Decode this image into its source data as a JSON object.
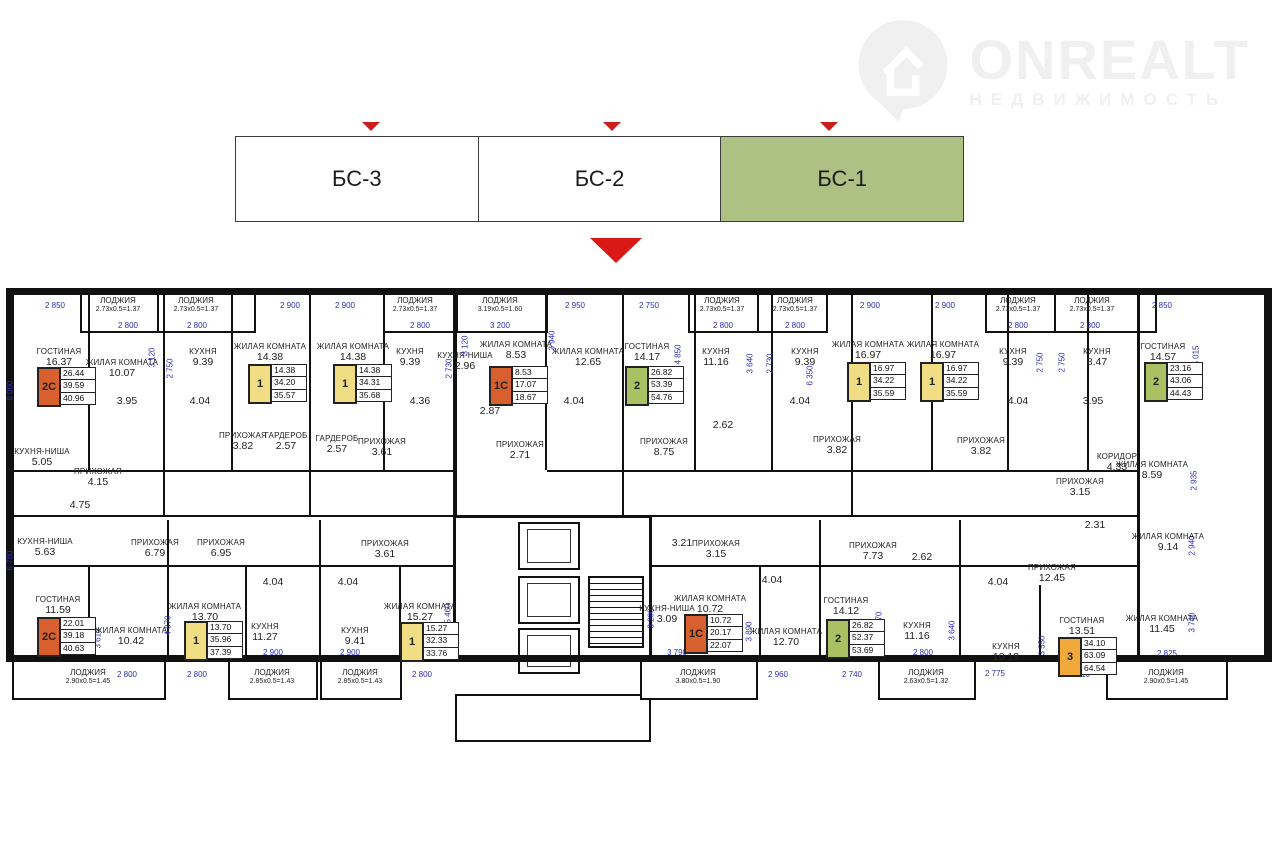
{
  "logo": {
    "name": "ONREALT",
    "subtitle": "НЕДВИЖИМОСТЬ"
  },
  "tabs": {
    "items": [
      {
        "label": "БС-3",
        "active": false
      },
      {
        "label": "БС-2",
        "active": false
      },
      {
        "label": "БС-1",
        "active": true
      }
    ],
    "active_color": "#aec185",
    "marker_color": "#c8201c"
  },
  "plan": {
    "rooms": [
      {
        "n": "ГОСТИНАЯ",
        "a": "16.37",
        "x": 59,
        "y": 352
      },
      {
        "n": "ЖИЛАЯ КОМНАТА",
        "a": "10.07",
        "x": 122,
        "y": 363
      },
      {
        "n": "КУХНЯ",
        "a": "9.39",
        "x": 203,
        "y": 352
      },
      {
        "n": "ЖИЛАЯ КОМНАТА",
        "a": "14.38",
        "x": 270,
        "y": 347
      },
      {
        "n": "ЖИЛАЯ КОМНАТА",
        "a": "14.38",
        "x": 353,
        "y": 347
      },
      {
        "n": "КУХНЯ",
        "a": "9.39",
        "x": 410,
        "y": 352
      },
      {
        "n": "КУХНЯ-НИША",
        "a": "2.96",
        "x": 465,
        "y": 356
      },
      {
        "n": "ЖИЛАЯ КОМНАТА",
        "a": "8.53",
        "x": 516,
        "y": 345
      },
      {
        "n": "ЖИЛАЯ КОМНАТА",
        "a": "12.65",
        "x": 588,
        "y": 352
      },
      {
        "n": "ГОСТИНАЯ",
        "a": "14.17",
        "x": 647,
        "y": 347
      },
      {
        "n": "КУХНЯ",
        "a": "11.16",
        "x": 716,
        "y": 352
      },
      {
        "n": "КУХНЯ",
        "a": "9.39",
        "x": 805,
        "y": 352
      },
      {
        "n": "ЖИЛАЯ КОМНАТА",
        "a": "16.97",
        "x": 868,
        "y": 345
      },
      {
        "n": "ЖИЛАЯ КОМНАТА",
        "a": "16.97",
        "x": 943,
        "y": 345
      },
      {
        "n": "КУХНЯ",
        "a": "9.39",
        "x": 1013,
        "y": 352
      },
      {
        "n": "КУХНЯ",
        "a": "8.47",
        "x": 1097,
        "y": 352
      },
      {
        "n": "ГОСТИНАЯ",
        "a": "14.57",
        "x": 1163,
        "y": 347
      },
      {
        "n": "КУХНЯ-НИША",
        "a": "5.05",
        "x": 42,
        "y": 452
      },
      {
        "n": "ПРИХОЖАЯ",
        "a": "4.15",
        "x": 98,
        "y": 472
      },
      {
        "n": "ПРИХОЖАЯ",
        "a": "3.82",
        "x": 243,
        "y": 436
      },
      {
        "n": "ГАРДЕРОБ",
        "a": "2.57",
        "x": 286,
        "y": 436
      },
      {
        "n": "ГАРДЕРОБ",
        "a": "2.57",
        "x": 337,
        "y": 439
      },
      {
        "n": "ПРИХОЖАЯ",
        "a": "3.61",
        "x": 382,
        "y": 442
      },
      {
        "n": "ПРИХОЖАЯ",
        "a": "2.71",
        "x": 520,
        "y": 445
      },
      {
        "n": "ПРИХОЖАЯ",
        "a": "8.75",
        "x": 664,
        "y": 442
      },
      {
        "n": "ПРИХОЖАЯ",
        "a": "3.82",
        "x": 837,
        "y": 440
      },
      {
        "n": "ПРИХОЖАЯ",
        "a": "3.82",
        "x": 981,
        "y": 441
      },
      {
        "n": "КОРИДОР",
        "a": "4.33",
        "x": 1117,
        "y": 457
      },
      {
        "n": "ПРИХОЖАЯ",
        "a": "3.15",
        "x": 1080,
        "y": 482
      },
      {
        "n": "ЖИЛАЯ КОМНАТА",
        "a": "8.59",
        "x": 1152,
        "y": 465
      },
      {
        "n": "",
        "a": "3.95",
        "x": 127,
        "y": 400
      },
      {
        "n": "",
        "a": "4.04",
        "x": 200,
        "y": 400
      },
      {
        "n": "",
        "a": "4.36",
        "x": 420,
        "y": 400
      },
      {
        "n": "",
        "a": "2.87",
        "x": 490,
        "y": 410
      },
      {
        "n": "",
        "a": "4.04",
        "x": 574,
        "y": 400
      },
      {
        "n": "",
        "a": "2.62",
        "x": 723,
        "y": 424
      },
      {
        "n": "",
        "a": "4.04",
        "x": 800,
        "y": 400
      },
      {
        "n": "",
        "a": "4.04",
        "x": 1018,
        "y": 400
      },
      {
        "n": "",
        "a": "3.95",
        "x": 1093,
        "y": 400
      },
      {
        "n": "",
        "a": "4.75",
        "x": 80,
        "y": 504
      },
      {
        "n": "КУХНЯ-НИША",
        "a": "5.63",
        "x": 45,
        "y": 542
      },
      {
        "n": "ПРИХОЖАЯ",
        "a": "6.79",
        "x": 155,
        "y": 543
      },
      {
        "n": "ПРИХОЖАЯ",
        "a": "6.95",
        "x": 221,
        "y": 543
      },
      {
        "n": "ГОСТИНАЯ",
        "a": "11.59",
        "x": 58,
        "y": 600
      },
      {
        "n": "ЖИЛАЯ КОМНАТА",
        "a": "10.42",
        "x": 131,
        "y": 631
      },
      {
        "n": "ЖИЛАЯ КОМНАТА",
        "a": "13.70",
        "x": 205,
        "y": 607
      },
      {
        "n": "КУХНЯ",
        "a": "11.27",
        "x": 265,
        "y": 627
      },
      {
        "n": "ПРИХОЖАЯ",
        "a": "3.61",
        "x": 385,
        "y": 544
      },
      {
        "n": "КУХНЯ",
        "a": "9.41",
        "x": 355,
        "y": 631
      },
      {
        "n": "ЖИЛАЯ КОМНАТА",
        "a": "15.27",
        "x": 420,
        "y": 607
      },
      {
        "n": "",
        "a": "4.04",
        "x": 273,
        "y": 581
      },
      {
        "n": "",
        "a": "4.04",
        "x": 348,
        "y": 581
      },
      {
        "n": "",
        "a": "3.21",
        "x": 682,
        "y": 542
      },
      {
        "n": "ПРИХОЖАЯ",
        "a": "3.15",
        "x": 716,
        "y": 544
      },
      {
        "n": "КУХНЯ-НИША",
        "a": "3.09",
        "x": 667,
        "y": 609
      },
      {
        "n": "ЖИЛАЯ КОМНАТА",
        "a": "10.72",
        "x": 710,
        "y": 599
      },
      {
        "n": "",
        "a": "4.04",
        "x": 772,
        "y": 579
      },
      {
        "n": "ЖИЛАЯ КОМНАТА",
        "a": "12.70",
        "x": 786,
        "y": 632
      },
      {
        "n": "ГОСТИНАЯ",
        "a": "14.12",
        "x": 846,
        "y": 601
      },
      {
        "n": "ПРИХОЖАЯ",
        "a": "7.73",
        "x": 873,
        "y": 546
      },
      {
        "n": "",
        "a": "2.62",
        "x": 922,
        "y": 556
      },
      {
        "n": "КУХНЯ",
        "a": "11.16",
        "x": 917,
        "y": 626
      },
      {
        "n": "",
        "a": "4.04",
        "x": 998,
        "y": 581
      },
      {
        "n": "",
        "a": "2.31",
        "x": 1095,
        "y": 524
      },
      {
        "n": "ПРИХОЖАЯ",
        "a": "12.45",
        "x": 1052,
        "y": 568
      },
      {
        "n": "КУХНЯ",
        "a": "10.19",
        "x": 1006,
        "y": 647
      },
      {
        "n": "ГОСТИНАЯ",
        "a": "13.51",
        "x": 1082,
        "y": 621
      },
      {
        "n": "ЖИЛАЯ КОМНАТА",
        "a": "9.14",
        "x": 1168,
        "y": 537
      },
      {
        "n": "ЖИЛАЯ КОМНАТА",
        "a": "11.45",
        "x": 1162,
        "y": 619
      }
    ],
    "loggias": [
      {
        "n": "ЛОДЖИЯ",
        "f": "2.73х0.5=1.37",
        "x": 118,
        "y": 296
      },
      {
        "n": "ЛОДЖИЯ",
        "f": "2.73х0.5=1.37",
        "x": 196,
        "y": 296
      },
      {
        "n": "ЛОДЖИЯ",
        "f": "2.73х0.5=1.37",
        "x": 415,
        "y": 296
      },
      {
        "n": "ЛОДЖИЯ",
        "f": "3.19х0.5=1.60",
        "x": 500,
        "y": 296
      },
      {
        "n": "ЛОДЖИЯ",
        "f": "2.73х0.5=1.37",
        "x": 722,
        "y": 296
      },
      {
        "n": "ЛОДЖИЯ",
        "f": "2.73х0.5=1.37",
        "x": 795,
        "y": 296
      },
      {
        "n": "ЛОДЖИЯ",
        "f": "2.73х0.5=1.37",
        "x": 1018,
        "y": 296
      },
      {
        "n": "ЛОДЖИЯ",
        "f": "2.73х0.5=1.37",
        "x": 1092,
        "y": 296
      },
      {
        "n": "ЛОДЖИЯ",
        "f": "2.90х0.5=1.45",
        "x": 88,
        "y": 668
      },
      {
        "n": "ЛОДЖИЯ",
        "f": "2.85х0.5=1.43",
        "x": 272,
        "y": 668
      },
      {
        "n": "ЛОДЖИЯ",
        "f": "2.85х0.5=1.43",
        "x": 360,
        "y": 668
      },
      {
        "n": "ЛОДЖИЯ",
        "f": "3.80х0.5=1.90",
        "x": 698,
        "y": 668
      },
      {
        "n": "ЛОДЖИЯ",
        "f": "2.63х0.5=1.32",
        "x": 926,
        "y": 668
      },
      {
        "n": "ЛОДЖИЯ",
        "f": "2.90х0.5=1.45",
        "x": 1166,
        "y": 668
      }
    ],
    "badges": [
      {
        "t": "2С",
        "c": "#d8602e",
        "vals": [
          "26.44",
          "39.59",
          "40.96"
        ],
        "x": 37,
        "y": 367
      },
      {
        "t": "1",
        "c": "#f0dc82",
        "vals": [
          "14.38",
          "34.20",
          "35.57"
        ],
        "x": 248,
        "y": 364
      },
      {
        "t": "1",
        "c": "#f0dc82",
        "vals": [
          "14.38",
          "34.31",
          "35.68"
        ],
        "x": 333,
        "y": 364
      },
      {
        "t": "1С",
        "c": "#d8602e",
        "vals": [
          "8.53",
          "17.07",
          "18.67"
        ],
        "x": 489,
        "y": 366
      },
      {
        "t": "2",
        "c": "#a9c162",
        "vals": [
          "26.82",
          "53.39",
          "54.76"
        ],
        "x": 625,
        "y": 366
      },
      {
        "t": "1",
        "c": "#f0dc82",
        "vals": [
          "16.97",
          "34.22",
          "35.59"
        ],
        "x": 847,
        "y": 362
      },
      {
        "t": "1",
        "c": "#f0dc82",
        "vals": [
          "16.97",
          "34.22",
          "35.59"
        ],
        "x": 920,
        "y": 362
      },
      {
        "t": "2",
        "c": "#a9c162",
        "vals": [
          "23.16",
          "43.06",
          "44.43"
        ],
        "x": 1144,
        "y": 362
      },
      {
        "t": "2С",
        "c": "#d8602e",
        "vals": [
          "22.01",
          "39.18",
          "40.63"
        ],
        "x": 37,
        "y": 617
      },
      {
        "t": "1",
        "c": "#f0dc82",
        "vals": [
          "13.70",
          "35.96",
          "37.39"
        ],
        "x": 184,
        "y": 621
      },
      {
        "t": "1",
        "c": "#f0dc82",
        "vals": [
          "15.27",
          "32.33",
          "33.76"
        ],
        "x": 400,
        "y": 622
      },
      {
        "t": "1С",
        "c": "#d8602e",
        "vals": [
          "10.72",
          "20.17",
          "22.07"
        ],
        "x": 684,
        "y": 614
      },
      {
        "t": "2",
        "c": "#a9c162",
        "vals": [
          "26.82",
          "52.37",
          "53.69"
        ],
        "x": 826,
        "y": 619
      },
      {
        "t": "3",
        "c": "#f2a93b",
        "vals": [
          "34.10",
          "63.09",
          "64.54"
        ],
        "x": 1058,
        "y": 637
      }
    ],
    "dims_h": [
      {
        "t": "2 850",
        "x": 55,
        "y": 305
      },
      {
        "t": "2 800",
        "x": 128,
        "y": 325
      },
      {
        "t": "2 800",
        "x": 197,
        "y": 325
      },
      {
        "t": "2 900",
        "x": 290,
        "y": 305
      },
      {
        "t": "2 900",
        "x": 345,
        "y": 305
      },
      {
        "t": "2 800",
        "x": 420,
        "y": 325
      },
      {
        "t": "3 200",
        "x": 500,
        "y": 325
      },
      {
        "t": "2 950",
        "x": 575,
        "y": 305
      },
      {
        "t": "2 750",
        "x": 649,
        "y": 305
      },
      {
        "t": "2 800",
        "x": 723,
        "y": 325
      },
      {
        "t": "2 800",
        "x": 795,
        "y": 325
      },
      {
        "t": "2 900",
        "x": 870,
        "y": 305
      },
      {
        "t": "2 900",
        "x": 945,
        "y": 305
      },
      {
        "t": "2 800",
        "x": 1018,
        "y": 325
      },
      {
        "t": "2 800",
        "x": 1090,
        "y": 325
      },
      {
        "t": "2 850",
        "x": 1162,
        "y": 305
      },
      {
        "t": "2 850",
        "x": 55,
        "y": 652
      },
      {
        "t": "2 800",
        "x": 127,
        "y": 674
      },
      {
        "t": "2 800",
        "x": 197,
        "y": 674
      },
      {
        "t": "2 900",
        "x": 273,
        "y": 652
      },
      {
        "t": "2 900",
        "x": 350,
        "y": 652
      },
      {
        "t": "2 800",
        "x": 422,
        "y": 674
      },
      {
        "t": "3 790",
        "x": 677,
        "y": 652
      },
      {
        "t": "2 960",
        "x": 778,
        "y": 674
      },
      {
        "t": "2 740",
        "x": 852,
        "y": 674
      },
      {
        "t": "2 800",
        "x": 923,
        "y": 652
      },
      {
        "t": "2 775",
        "x": 995,
        "y": 673
      },
      {
        "t": "3 710",
        "x": 1080,
        "y": 674
      },
      {
        "t": "2 825",
        "x": 1167,
        "y": 653
      }
    ],
    "dims_v": [
      {
        "t": "8 060",
        "x": 10,
        "y": 390
      },
      {
        "t": "6 780",
        "x": 10,
        "y": 560
      },
      {
        "t": "3 120",
        "x": 152,
        "y": 357
      },
      {
        "t": "2 750",
        "x": 170,
        "y": 368
      },
      {
        "t": "3 120",
        "x": 465,
        "y": 345
      },
      {
        "t": "2 730",
        "x": 449,
        "y": 368
      },
      {
        "t": "3 940",
        "x": 552,
        "y": 340
      },
      {
        "t": "4 850",
        "x": 678,
        "y": 354
      },
      {
        "t": "3 640",
        "x": 750,
        "y": 363
      },
      {
        "t": "2 730",
        "x": 770,
        "y": 363
      },
      {
        "t": "6 350",
        "x": 810,
        "y": 375
      },
      {
        "t": "6 350",
        "x": 862,
        "y": 375
      },
      {
        "t": "2 750",
        "x": 1040,
        "y": 362
      },
      {
        "t": "2 750",
        "x": 1062,
        "y": 362
      },
      {
        "t": "5 015",
        "x": 1196,
        "y": 355
      },
      {
        "t": "2 935",
        "x": 1194,
        "y": 480
      },
      {
        "t": "2 940",
        "x": 1192,
        "y": 545
      },
      {
        "t": "3 740",
        "x": 1192,
        "y": 622
      },
      {
        "t": "3 610",
        "x": 98,
        "y": 638
      },
      {
        "t": "4 870",
        "x": 168,
        "y": 625
      },
      {
        "t": "5 460",
        "x": 448,
        "y": 613
      },
      {
        "t": "3 290",
        "x": 651,
        "y": 618
      },
      {
        "t": "3 890",
        "x": 749,
        "y": 631
      },
      {
        "t": "4 870",
        "x": 879,
        "y": 621
      },
      {
        "t": "3 640",
        "x": 952,
        "y": 630
      },
      {
        "t": "3 550",
        "x": 1042,
        "y": 645
      }
    ]
  }
}
